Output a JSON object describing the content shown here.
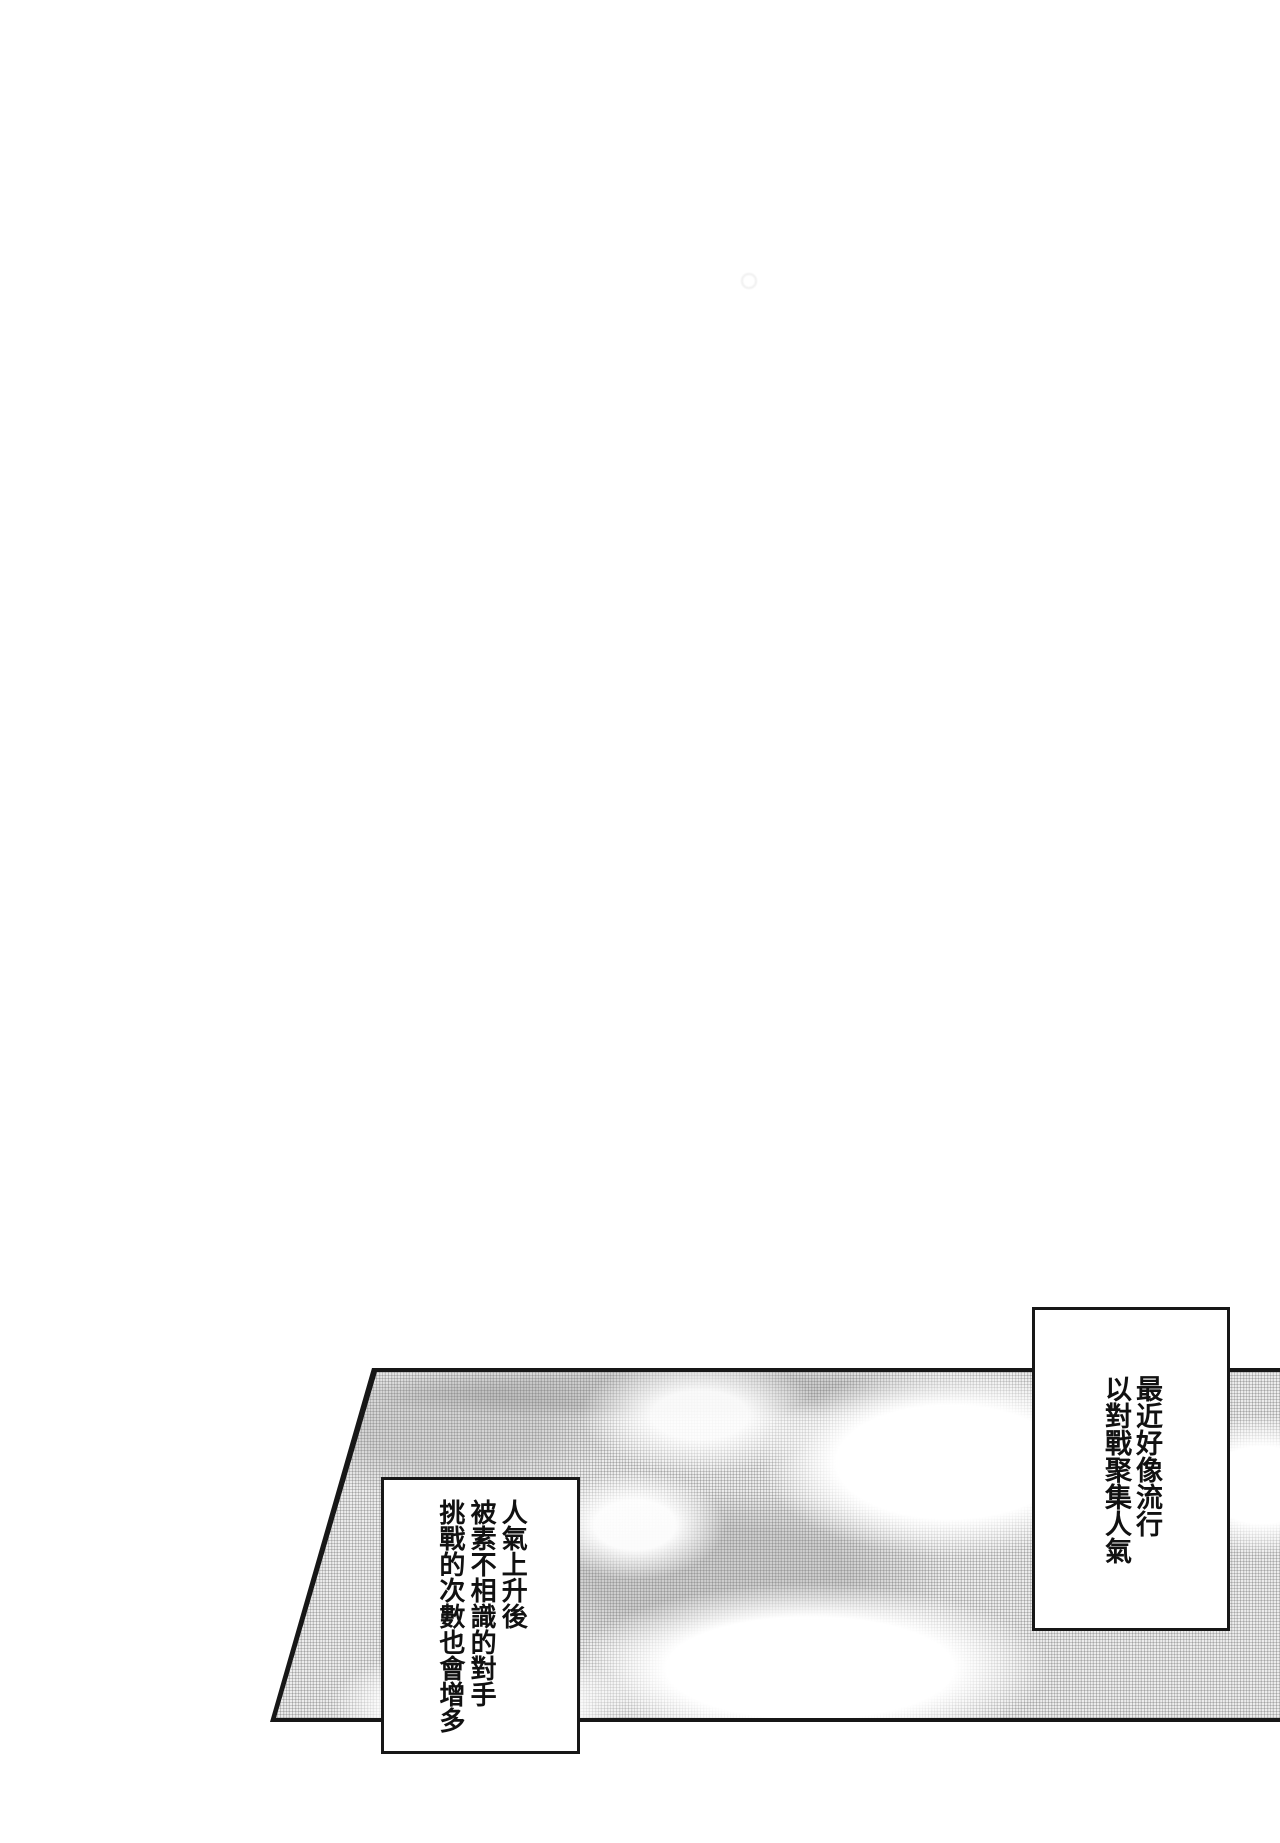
{
  "page": {
    "type": "manga page scan",
    "background_color": "#ffffff",
    "ink_color": "#171717",
    "halftone_color": "#a8a8a8"
  },
  "panel": {
    "content": "halftone sky with white clouds",
    "shape": "slanted parallelogram bleeding off right edge"
  },
  "captions": [
    {
      "position": "top-right",
      "text": "最近好像流行\n以對戰聚集人氣"
    },
    {
      "position": "bottom-left",
      "text": "人氣上升後\n被素不相識的對手\n挑戰的次數也會增多"
    }
  ]
}
